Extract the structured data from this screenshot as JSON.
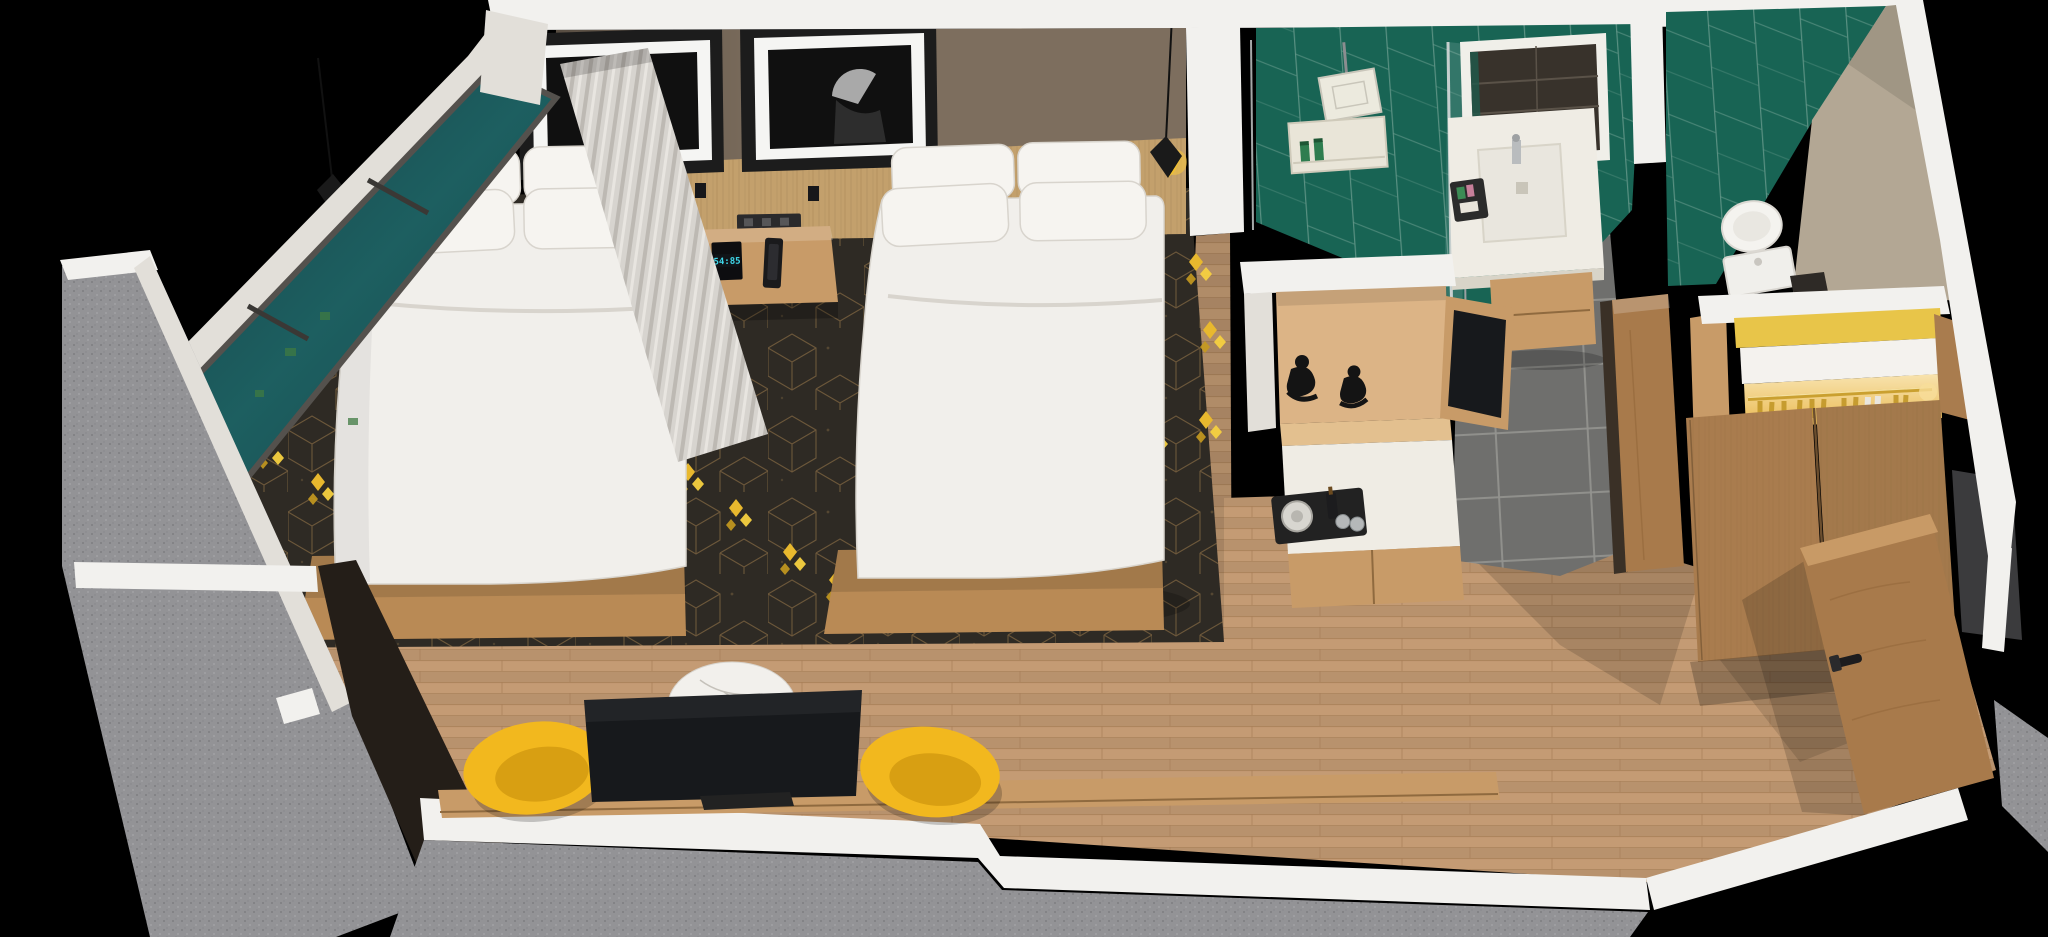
{
  "canvas": {
    "width": 2048,
    "height": 937
  },
  "image_type": "3d-rendered isometric cutaway floor plan of a hotel guest room, black background",
  "colors": {
    "bg": "#000000",
    "wall_cap": "#f2f1ee",
    "wall_cap_shade": "#e2dfd9",
    "exterior_gray": "#939396",
    "taupe_wall": "#7d6e5e",
    "headboard_wood": "#c3a06c",
    "floor_wood": "#c49b74",
    "plank_line": "#a87f57",
    "carpet": "#2e2a24",
    "carpet_line": "#8a6d44",
    "carpet_gold": "#e8b82e",
    "glass_teal": "#1d5a5e",
    "window_frame": "#6e6b67",
    "curtain": "#d7d4cf",
    "bed_white": "#f1efeb",
    "bed_base_wood": "#b98a55",
    "art_frame": "#1c1c1c",
    "art_mat": "#f5f5f3",
    "art_image": "#101010",
    "pendant_black": "#1a1a1a",
    "pendant_yellow": "#f2c12e",
    "tile_green": "#186454",
    "tile_green_grout": "#64988a",
    "tile_gray": "#6f6f6d",
    "counter_white": "#efece4",
    "unit_wood": "#c89b68",
    "wardrobe_wood": "#a97c4e",
    "door_wood": "#a87a4b",
    "tv_black": "#17191c",
    "chair_yellow": "#f2b81e",
    "marble": "#f2f0ec",
    "figurine": "#141414",
    "closet_yellow": "#e8c549",
    "hanger_gold": "#c49a2c",
    "greige": "#b3a794",
    "dark_face": "#241e18"
  },
  "scene": {
    "description": "Dollhouse-style top cutaway of a hotel room: twin queen bedroom with window wall, work lounge, wet bar, green-tiled shower bathroom, separate toilet room, lighted wardrobe and entry",
    "bedroom": {
      "artworks": [
        "framed monochrome bird artwork",
        "framed monochrome figure-with-fan artwork"
      ],
      "bed_count": 2,
      "bedding": "white duvets with four white pillows per bed on wood platform bases",
      "nightstand": {
        "clock_display": "54:85",
        "items": [
          "alarm clock with cyan digits",
          "phone dock",
          "wall power outlet above"
        ]
      },
      "lighting": [
        "black-and-yellow pendant lamp left",
        "black-and-yellow pendant lamp right",
        "two black wall reading sconces"
      ],
      "window": "full-height teal glazed window wall with sheer pleated curtain",
      "carpet": "charcoal carpet with tan cube lattice and yellow diamond clusters"
    },
    "work_lounge": {
      "tv": "large dark flat panel on wood media ledge",
      "table": "round white marble bistro table",
      "chairs": "two mustard-yellow shell chairs",
      "accent_wall": "dark charcoal alcove wall"
    },
    "wet_bar": {
      "shelf_decor": [
        "two black seated sculptures"
      ],
      "counter_items": [
        "black service tray",
        "kettle",
        "dark bottle",
        "two glasses"
      ],
      "side_screen": "dark panel facing hallway"
    },
    "bathroom": {
      "wall_tile": "emerald green chevron tile",
      "fixtures": [
        "square rain shower head",
        "tiled niche with two green toiletry bottles",
        "glass shower screen",
        "LED-framed mirror",
        "white vessel sink on floating wood vanity",
        "black amenity tray"
      ],
      "floor": "graphite porcelain tile"
    },
    "toilet_room": {
      "wall_tile": "emerald green chevron tile",
      "fixtures": [
        "white toilet"
      ]
    },
    "closet": {
      "interior": "warm-lit niche with brass rail and gold hangers",
      "doors": "double wood doors"
    },
    "entry": {
      "door": "wood entry door standing ajar with black lever handle",
      "floor": "light oak planks"
    }
  }
}
